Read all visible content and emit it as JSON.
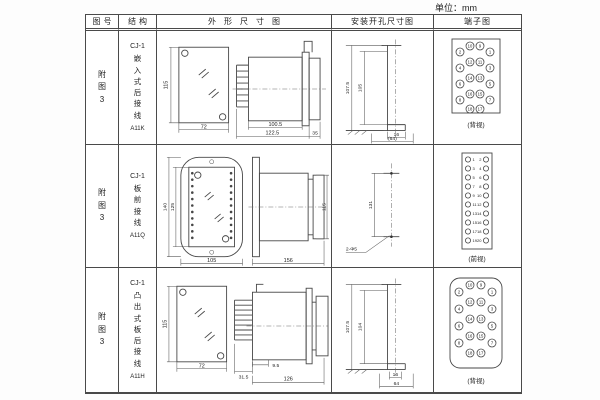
{
  "unit_label": "单位：mm",
  "headers": {
    "figure": "图号",
    "structure": "结构",
    "outline": "外形尺寸图",
    "install": "安装开孔尺寸图",
    "terminal": "端子图"
  },
  "rows": [
    {
      "figure_no": "附图3",
      "model": "CJ-1",
      "structure_name": "嵌入式后接线",
      "code": "A11K",
      "outline": {
        "front_height": "115",
        "front_width": "72",
        "body_length": "100.5",
        "overall_length": "122.5",
        "rear_depth": "35"
      },
      "install": {
        "outer_height": "107.5",
        "inner_height": "105",
        "slot_width": "16",
        "opening_width": "(64)"
      },
      "terminal": {
        "view_label": "(背视)",
        "cols": {
          "outer_left": [
            "2",
            "4",
            "6",
            "8"
          ],
          "mid_left": [
            "10",
            "12",
            "14",
            "16",
            "18"
          ],
          "mid_right": [
            "9",
            "11",
            "13",
            "15",
            "17"
          ],
          "outer_right": [
            "1",
            "3",
            "5",
            "7"
          ]
        }
      }
    },
    {
      "figure_no": "附图3",
      "model": "CJ-1",
      "structure_name": "板前接线",
      "code": "A11Q",
      "outline": {
        "front_outer_height": "140",
        "front_inner_height": "125",
        "front_width": "105",
        "side_length": "156",
        "side_height": "115"
      },
      "install": {
        "hole_spacing": "131",
        "holes_label": "2-Φ5"
      },
      "terminal": {
        "view_label": "(前视)",
        "left_numbers": [
          "1",
          "3",
          "5",
          "7",
          "9",
          "11",
          "13",
          "15",
          "17",
          "19"
        ],
        "right_numbers": [
          "2",
          "4",
          "6",
          "8",
          "10",
          "12",
          "14",
          "16",
          "18",
          "20"
        ]
      }
    },
    {
      "figure_no": "附图3",
      "model": "CJ-1",
      "structure_name": "凸出式板后接线",
      "code": "A11H",
      "outline": {
        "front_height": "115",
        "front_width": "72",
        "pin_depth": "31.5",
        "step": "9.5",
        "body_length": "126"
      },
      "install": {
        "outer_height": "107.5",
        "inner_height": "104",
        "slot_width": "16",
        "opening_width": "64"
      },
      "terminal": {
        "view_label": "(背视)",
        "cols": {
          "outer_left": [
            "2",
            "4",
            "6",
            "8"
          ],
          "mid_left": [
            "10",
            "12",
            "14",
            "16",
            "18"
          ],
          "mid_right": [
            "9",
            "11",
            "13",
            "15",
            "17"
          ],
          "outer_right": [
            "1",
            "3",
            "5",
            "7"
          ]
        }
      }
    }
  ]
}
